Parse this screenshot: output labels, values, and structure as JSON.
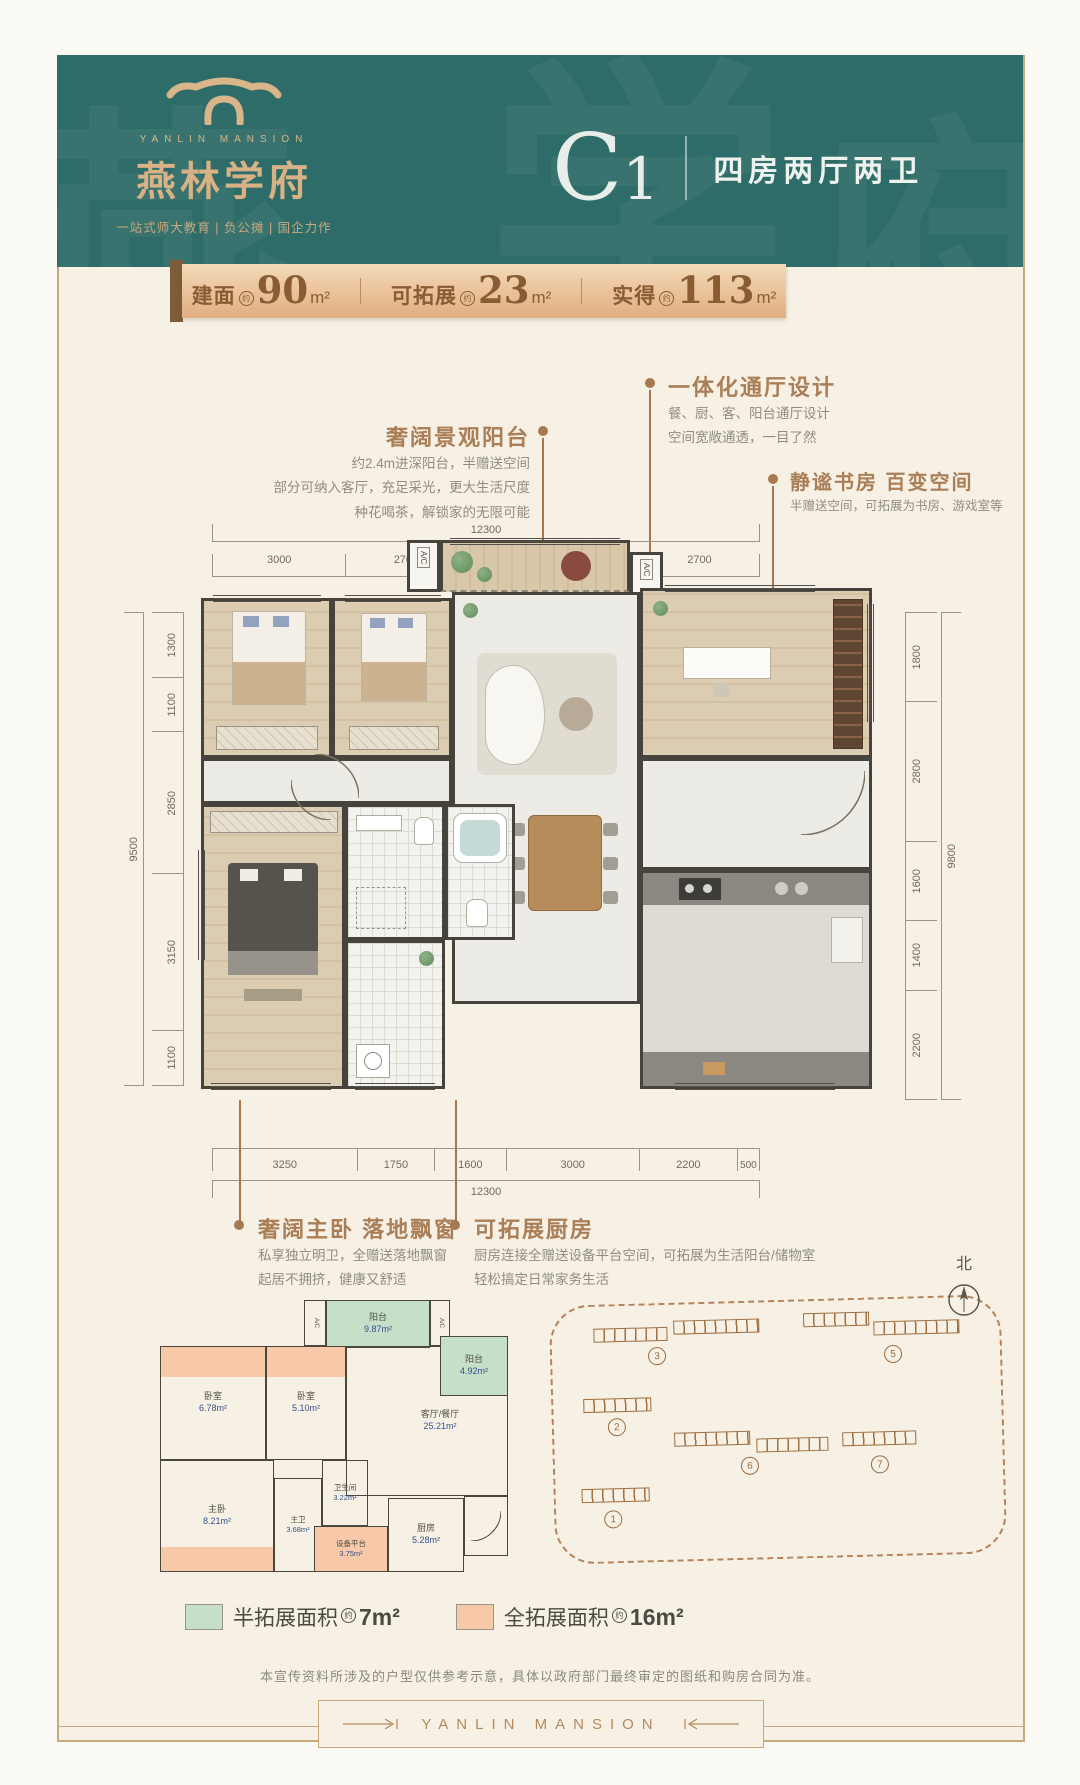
{
  "header": {
    "brand_en": "YANLIN MANSION",
    "brand_cn": "燕林学府",
    "tagline": "一站式师大教育 | 负公摊 | 国企力作",
    "unit_code_main": "C",
    "unit_code_num": "1",
    "unit_desc": "四房两厅两卫"
  },
  "area_bar": {
    "items": [
      {
        "label": "建面",
        "approx": "约",
        "value": "90",
        "unit": "m²"
      },
      {
        "label": "可拓展",
        "approx": "约",
        "value": "23",
        "unit": "m²"
      },
      {
        "label": "实得",
        "approx": "约",
        "value": "113",
        "unit": "m²"
      }
    ]
  },
  "callouts": {
    "balcony": {
      "title": "奢阔景观阳台",
      "line1": "约2.4m进深阳台，半赠送空间",
      "line2": "部分可纳入客厅，充足采光，更大生活尺度",
      "line3": "种花喝茶，解锁家的无限可能"
    },
    "hall": {
      "title": "一体化通厅设计",
      "line1": "餐、厨、客、阳台通厅设计",
      "line2": "空间宽敞通透，一目了然"
    },
    "study": {
      "title": "静谧书房 百变空间",
      "line1": "半赠送空间，可拓展为书房、游戏室等"
    },
    "master": {
      "title": "奢阔主卧 落地飘窗",
      "line1": "私享独立明卫，全赠送落地飘窗",
      "line2": "起居不拥挤，健康又舒适"
    },
    "kitchen": {
      "title": "可拓展厨房",
      "line1": "厨房连接全赠送设备平台空间，可拓展为生活阳台/储物室",
      "line2": "轻松搞定日常家务生活"
    }
  },
  "dimensions": {
    "top": {
      "total": "12300",
      "segments": [
        "3000",
        "2700",
        "3900",
        "2700"
      ]
    },
    "left": {
      "total": "9500",
      "segments": [
        "1300",
        "1100",
        "2850",
        "3150",
        "1100"
      ]
    },
    "right": {
      "total": "9800",
      "segments": [
        "1800",
        "2800",
        "1600",
        "1400",
        "2200"
      ]
    },
    "bottom": {
      "total": "12300",
      "segments": [
        "3250",
        "1750",
        "1600",
        "3000",
        "2200",
        "500"
      ]
    }
  },
  "plan": {
    "ac_label": "A/C"
  },
  "schematic": {
    "ac_label": "A/C",
    "rooms": {
      "balcony_big": {
        "name": "阳台",
        "area": "9.87m²"
      },
      "balcony_small": {
        "name": "阳台",
        "area": "4.92m²"
      },
      "bedroom1": {
        "name": "卧室",
        "area": "6.78m²"
      },
      "bedroom2": {
        "name": "卧室",
        "area": "5.10m²"
      },
      "living": {
        "name": "客厅/餐厅",
        "area": "25.21m²"
      },
      "master": {
        "name": "主卧",
        "area": "8.21m²"
      },
      "master_bath": {
        "name": "主卫",
        "area": "3.68m²"
      },
      "bath": {
        "name": "卫生间",
        "area": "3.22m²"
      },
      "equipment": {
        "name": "设备平台",
        "area": "3.75m²"
      },
      "kitchen": {
        "name": "厨房",
        "area": "5.28m²"
      }
    }
  },
  "legend": {
    "half": {
      "label": "半拓展面积",
      "approx": "约",
      "value": "7m²"
    },
    "full": {
      "label": "全拓展面积",
      "approx": "约",
      "value": "16m²"
    }
  },
  "siteplan": {
    "north_label": "北",
    "b1": "1",
    "b2": "2",
    "b3": "3",
    "b5": "5",
    "b6": "6",
    "b7": "7"
  },
  "disclaimer": "本宣传资料所涉及的户型仅供参考示意，具体以政府部门最终审定的图纸和购房合同为准。",
  "footer": {
    "brand": "YANLIN MANSION"
  },
  "colors": {
    "teal": "#2e6c69",
    "gold": "#d8b185",
    "bronze": "#8a5c34",
    "callout": "#aa7e57",
    "half_expand_green": "#c5dfc9",
    "full_expand_pink": "#f7c9a9"
  }
}
